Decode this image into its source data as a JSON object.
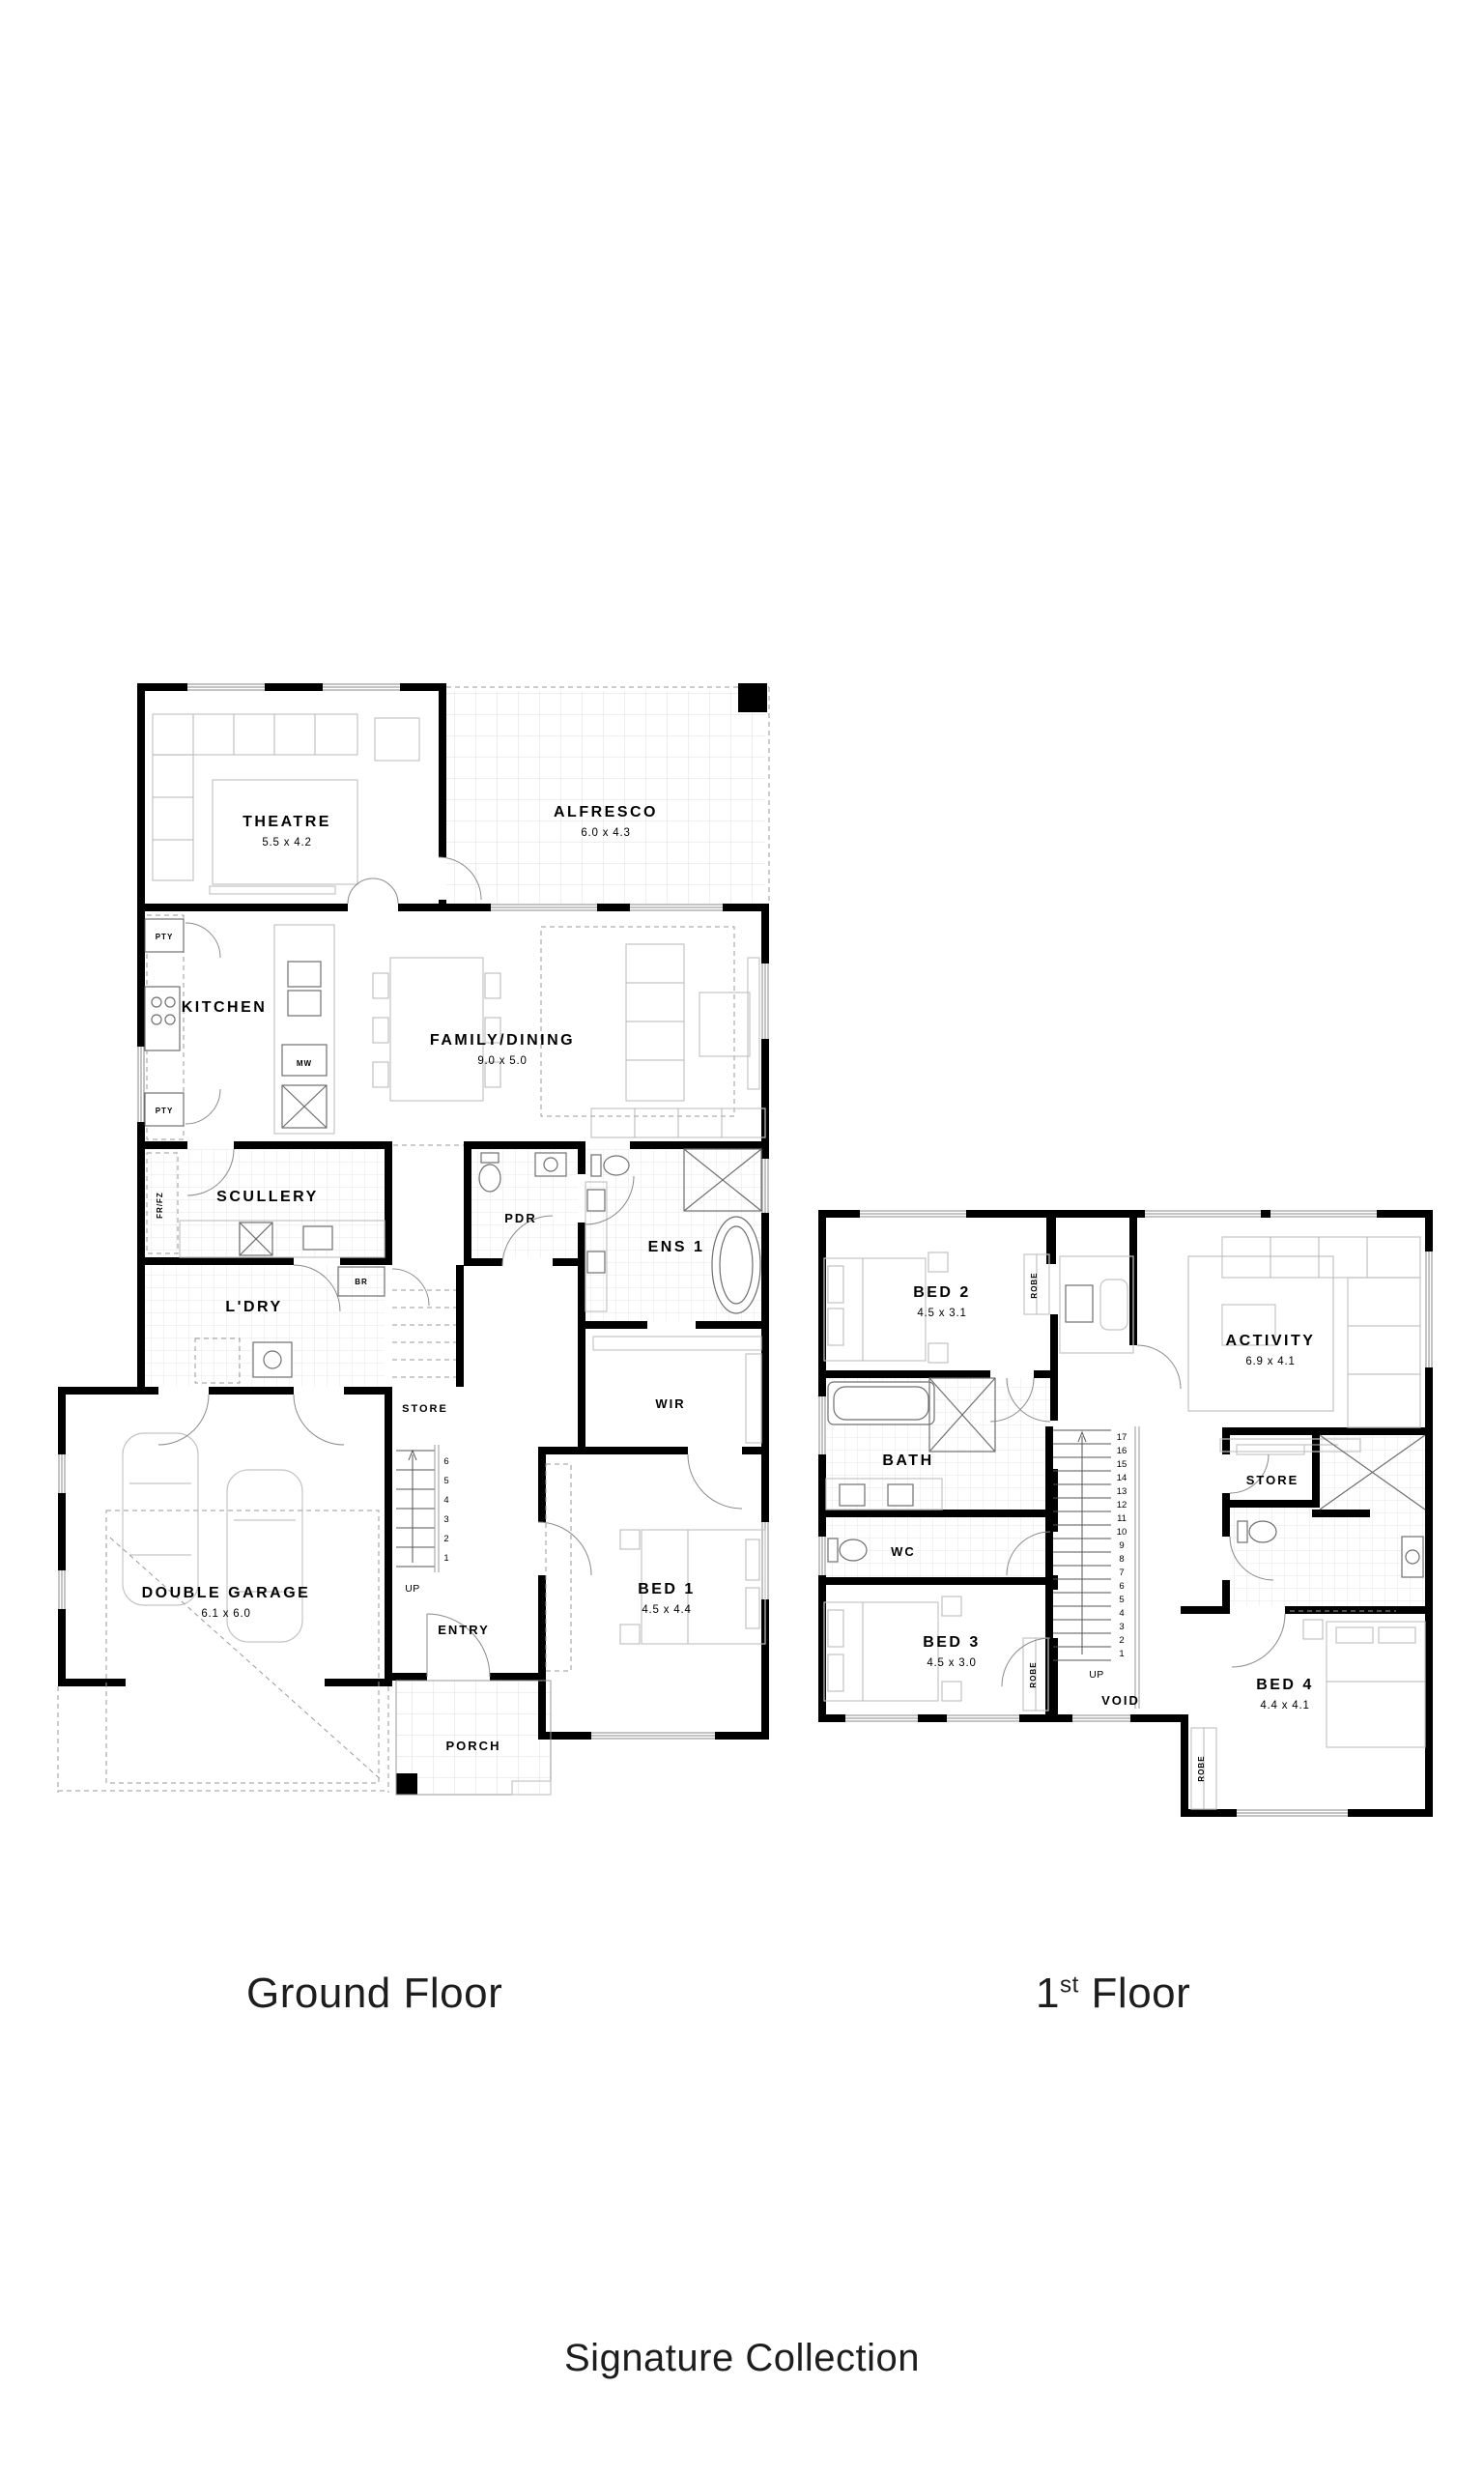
{
  "colors": {
    "wall": "#000000",
    "furniture": "#c4c4c4",
    "fixture": "#6f6f6f",
    "tile": "#e7e7e7",
    "dash": "#9a9a9a",
    "caption_text": "#1d1d1d"
  },
  "captions": {
    "ground": "Ground Floor",
    "first_number": "1",
    "first_ordinal": "st",
    "first_word": "Floor",
    "collection": "Signature Collection"
  },
  "ground_floor": {
    "rooms": {
      "theatre": {
        "label": "THEATRE",
        "dims": "5.5 x 4.2"
      },
      "alfresco": {
        "label": "ALFRESCO",
        "dims": "6.0 x 4.3"
      },
      "kitchen": {
        "label": "KITCHEN"
      },
      "family": {
        "label": "FAMILY/DINING",
        "dims": "9.0 x 5.0"
      },
      "scullery": {
        "label": "SCULLERY"
      },
      "ldry": {
        "label": "L'DRY"
      },
      "pdr": {
        "label": "PDR"
      },
      "ens1": {
        "label": "ENS 1"
      },
      "wir": {
        "label": "WIR"
      },
      "garage": {
        "label": "DOUBLE GARAGE",
        "dims": "6.1 x 6.0"
      },
      "store": {
        "label": "STORE"
      },
      "entry": {
        "label": "ENTRY"
      },
      "bed1": {
        "label": "BED 1",
        "dims": "4.5 x 4.4"
      },
      "porch": {
        "label": "PORCH"
      }
    },
    "annotations": {
      "pty_top": "PTY",
      "pty_bottom": "PTY",
      "frfz": "FR/FZ",
      "br": "BR",
      "mw": "MW",
      "up": "UP"
    },
    "stairs": [
      "6",
      "5",
      "4",
      "3",
      "2",
      "1"
    ]
  },
  "first_floor": {
    "rooms": {
      "bed2": {
        "label": "BED 2",
        "dims": "4.5 x 3.1"
      },
      "activity": {
        "label": "ACTIVITY",
        "dims": "6.9 x 4.1"
      },
      "bath": {
        "label": "BATH"
      },
      "wc": {
        "label": "WC"
      },
      "bed3": {
        "label": "BED 3",
        "dims": "4.5 x 3.0"
      },
      "store": {
        "label": "STORE"
      },
      "void": {
        "label": "VOID"
      },
      "bed4": {
        "label": "BED 4",
        "dims": "4.4 x 4.1"
      }
    },
    "annotations": {
      "robe_bed2": "ROBE",
      "robe_bed3": "ROBE",
      "robe_bed4": "ROBE",
      "up": "UP"
    },
    "stairs": [
      "17",
      "16",
      "15",
      "14",
      "13",
      "12",
      "11",
      "10",
      "9",
      "8",
      "7",
      "6",
      "5",
      "4",
      "3",
      "2",
      "1"
    ]
  }
}
